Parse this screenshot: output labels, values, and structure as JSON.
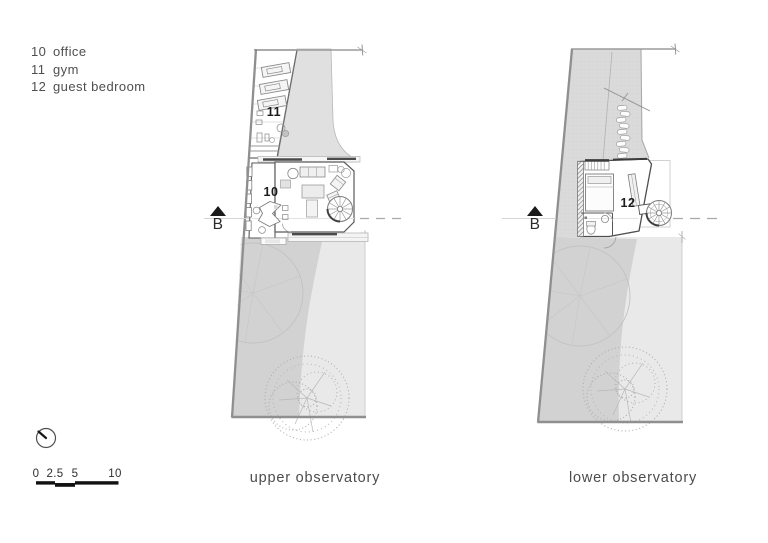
{
  "legend": {
    "items": [
      {
        "number": "10",
        "label": "office"
      },
      {
        "number": "11",
        "label": "gym"
      },
      {
        "number": "12",
        "label": "guest bedroom"
      }
    ]
  },
  "plans": [
    {
      "caption": "upper observatory",
      "section_marker": "B",
      "rooms": [
        {
          "number": "11"
        },
        {
          "number": "10"
        }
      ]
    },
    {
      "caption": "lower observatory",
      "section_marker": "B",
      "rooms": [
        {
          "number": "12"
        }
      ]
    }
  ],
  "scale_bar": {
    "ticks": [
      "0",
      "2.5",
      "5",
      "10"
    ]
  },
  "icons": {
    "north_indicator": "north-indicator-icon",
    "section_arrow": "section-arrow-icon"
  },
  "colors": {
    "ground_dark": "#d2d2d2",
    "ground_light": "#e9e9e9",
    "upper_ground": "#dadada",
    "wall": "#5a5a5a",
    "text": "#4a4a4a",
    "section_marker": "#111111"
  }
}
